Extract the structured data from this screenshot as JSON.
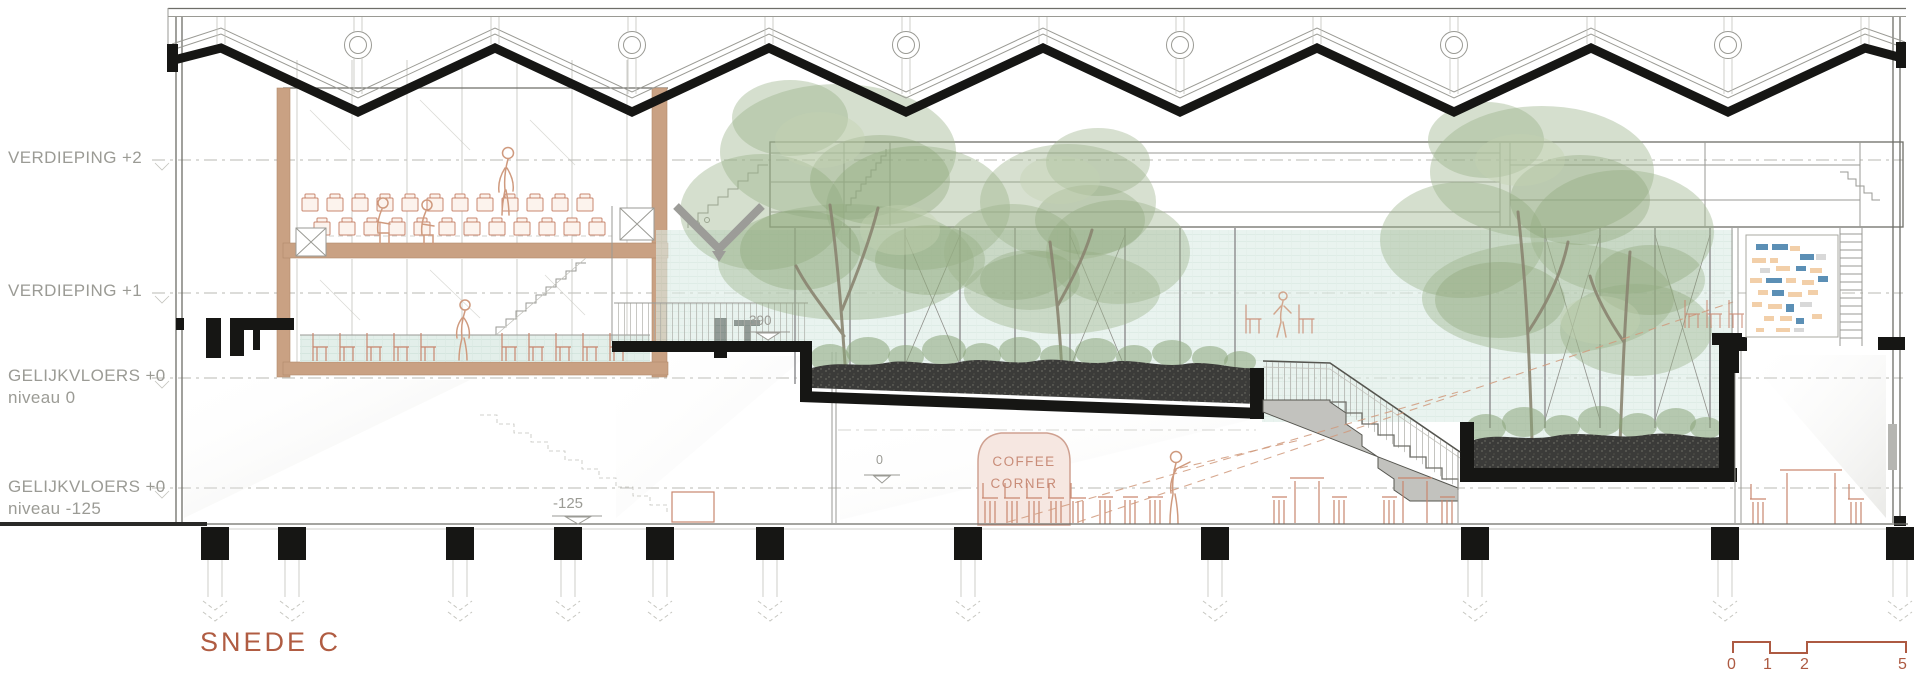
{
  "drawing_title": {
    "text": "SNEDE C"
  },
  "level_labels": [
    {
      "label": "VERDIEPING +2",
      "sub": ""
    },
    {
      "label": "VERDIEPING +1",
      "sub": ""
    },
    {
      "label": "GELIJKVLOERS +0",
      "sub": "niveau 0"
    },
    {
      "label": "GELIJKVLOERS +0",
      "sub": "niveau -125"
    }
  ],
  "annotations": {
    "mezzanine_level": "390",
    "ground_zero": "0",
    "basement_level": "-125"
  },
  "coffee_corner": {
    "line1": "COFFEE",
    "line2": "CORNER"
  },
  "scale_bar": {
    "ticks": [
      "0",
      "1",
      "2",
      "5"
    ]
  },
  "colors": {
    "accent_terracotta": "#b05c42",
    "label_gray": "#9b9b95",
    "furniture_terracotta": "#c9876f",
    "wood": "#c9a183",
    "soil_dark": "#3b3b39",
    "glass_tint": "#dcebe5",
    "foliage_green": "#9cb28a",
    "kiosk_fill": "#f6e7e1",
    "mosaic_blue": "#5b8fb5",
    "mosaic_peach": "#f2cfa9",
    "section_black": "#161614"
  }
}
